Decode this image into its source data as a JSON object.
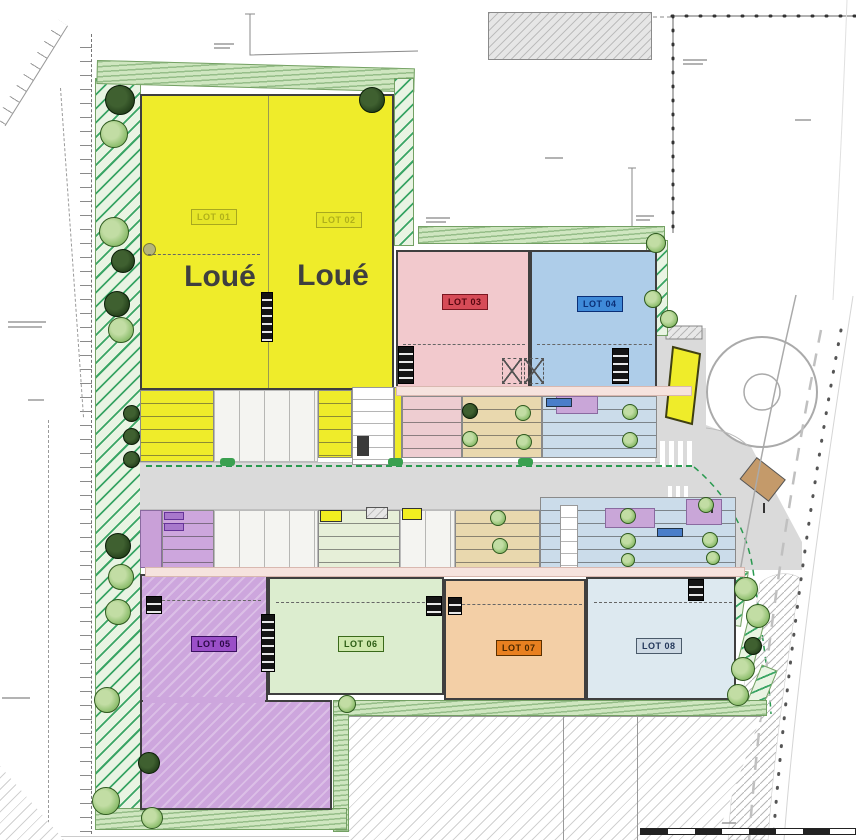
{
  "plan": {
    "type": "architectural site plan (ground floor commercialization plan)",
    "lots": [
      {
        "id": "lot-01",
        "label": "LOT 01",
        "status": "Loué",
        "area_color": "#efec2a",
        "tag_bg": "#e6e628",
        "tag_text": "#b0b01a",
        "tag_border": "#a8a81e"
      },
      {
        "id": "lot-02",
        "label": "LOT 02",
        "status": "Loué",
        "area_color": "#efec2a",
        "tag_bg": "#e6e628",
        "tag_text": "#b0b01a",
        "tag_border": "#a8a81e"
      },
      {
        "id": "lot-03",
        "label": "LOT 03",
        "area_color": "#f2c9cd",
        "tag_bg": "#d64b57",
        "tag_text": "#55060f",
        "tag_border": "#7a1620"
      },
      {
        "id": "lot-04",
        "label": "LOT 04",
        "area_color": "#aecde9",
        "tag_bg": "#3f8ad9",
        "tag_text": "#0b2f77",
        "tag_border": "#0b2f77"
      },
      {
        "id": "lot-05",
        "label": "LOT 05",
        "area_color": "#cda6dd",
        "tag_bg": "#9a4fc8",
        "tag_text": "#2a0845",
        "tag_border": "#3a1060"
      },
      {
        "id": "lot-06",
        "label": "LOT 06",
        "area_color": "#dcedcf",
        "tag_bg": "#cfe9ad",
        "tag_text": "#2b5c13",
        "tag_border": "#3a6a1a"
      },
      {
        "id": "lot-07",
        "label": "LOT 07",
        "area_color": "#f3cfa6",
        "tag_bg": "#e88020",
        "tag_text": "#4a2800",
        "tag_border": "#5a3000"
      },
      {
        "id": "lot-08",
        "label": "LOT 08",
        "area_color": "#dde9f0",
        "tag_bg": "#cdd9e4",
        "tag_text": "#22365a",
        "tag_border": "#4a5a6a"
      }
    ],
    "palette": {
      "hedge_green": "#cfe6c0",
      "hedge_hatch": "#3aa565",
      "road_gray": "#dadada",
      "site_boundary_green": "#2a9a50",
      "parking_yellow": "#f2ee20",
      "walkway_pink": "#f6e3de",
      "tree_green": "#8fbf6f",
      "tree_dark": "#24401b",
      "hatch_line": "#b5b5b5",
      "brown_ramp": "#c49a6a"
    }
  }
}
